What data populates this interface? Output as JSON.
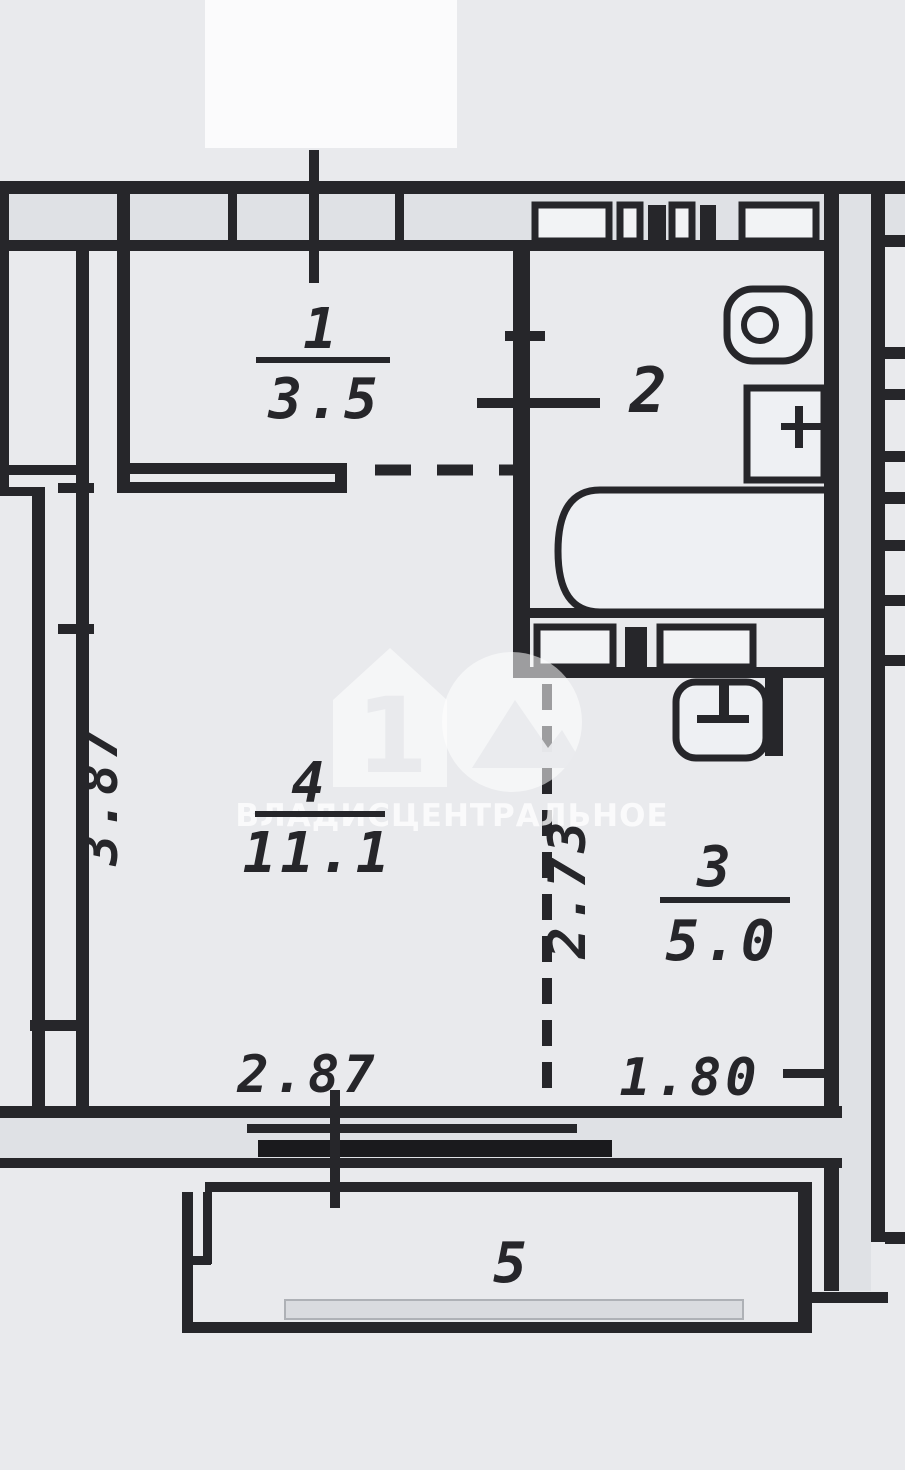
{
  "plan": {
    "title": "apartment-floor-plan",
    "rooms": [
      {
        "number": "1",
        "area": "3.5"
      },
      {
        "number": "2",
        "area": ""
      },
      {
        "number": "3",
        "area": "5.0"
      },
      {
        "number": "4",
        "area": "11.1"
      },
      {
        "number": "5",
        "area": ""
      }
    ],
    "dimensions": {
      "left": "3.87",
      "inner": "2.73",
      "bottom_left": "2.87",
      "bottom_right": "1.80"
    },
    "fixtures": [
      "toilet",
      "cistern",
      "bathtub",
      "washbasin"
    ],
    "watermark": {
      "logo_digit": "1",
      "text": "ВЛАДИСЦЕНТРАЛЬНОЕ"
    },
    "colors": {
      "paper": "#e9eaed",
      "ink": "#26262a",
      "wall_fill": "#dfe1e5",
      "window": "#1a1a1d",
      "watermark": "#ffffff"
    }
  }
}
